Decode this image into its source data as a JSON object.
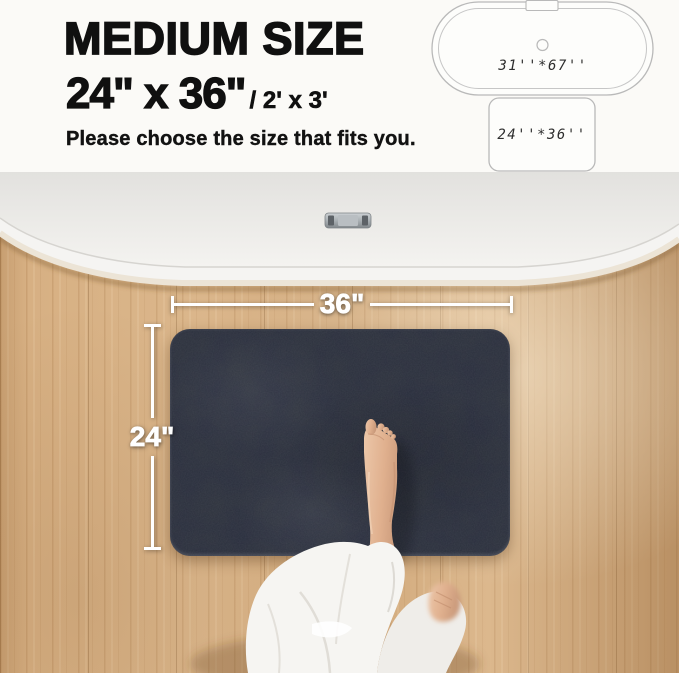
{
  "header": {
    "title": "MEDIUM SIZE",
    "size_primary": "24\"  x 36\"",
    "size_secondary": "/ 2' x 3'",
    "note": "Please choose the size that fits you.",
    "diagrams": {
      "bathtub_label": "31''*67''",
      "mat_label": "24''*36''"
    }
  },
  "photo": {
    "mat_width_label": "36\"",
    "mat_height_label": "24\""
  },
  "colors": {
    "mat": "#2e333d",
    "floor_wood": "#d7b083",
    "tub_white": "#f4f3f1",
    "annotation_white": "#ffffff",
    "heading_text": "#101010",
    "diagram_outline": "#b9b9b9",
    "skin": "#e3b493",
    "robe_white": "#f6f5f2"
  }
}
